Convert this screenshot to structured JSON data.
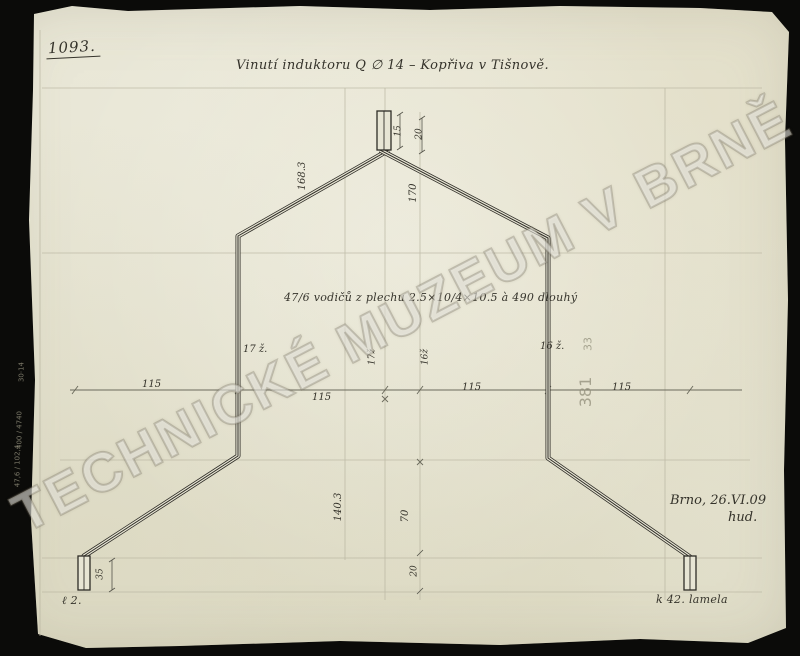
{
  "page": {
    "drawing_number": "1093.",
    "title": "Vinutí induktoru Q ∅ 14  –  Kopřiva v Tišnově.",
    "winding_note": "47/6 vodičů z plechu 2.5×10/4×10.5 à 490 dlouhý",
    "place_date": "Brno, 26.VI.09",
    "signature": "hud.",
    "terminal_left_label": "ℓ 2.",
    "terminal_right_label": "k 42. lamela",
    "watermark": "TECHNICKÉ MUZEUM V BRNĚ",
    "archive_number": "381",
    "archive_number_2": "33",
    "margin_notes": [
      "30·14",
      "400 / 4740",
      "47,6 / 102,4"
    ],
    "paper_color": "#e7e5d4",
    "ink_color": "#2e2c26"
  },
  "dims": {
    "span_labels": [
      "115",
      "115",
      "115",
      "115"
    ],
    "top_terminal_height": "15",
    "top_offset": "20",
    "slope_upper_left": "168.3",
    "height_upper_right": "170",
    "turns_left": "17 ž.",
    "turns_right": "16 ž.",
    "turns_center_left": "17ž",
    "turns_center_right": "16ž",
    "height_lower_left": "140.3",
    "height_lower_right": "70",
    "offset_bottom_center": "20",
    "terminal_bottom_height": "35"
  }
}
